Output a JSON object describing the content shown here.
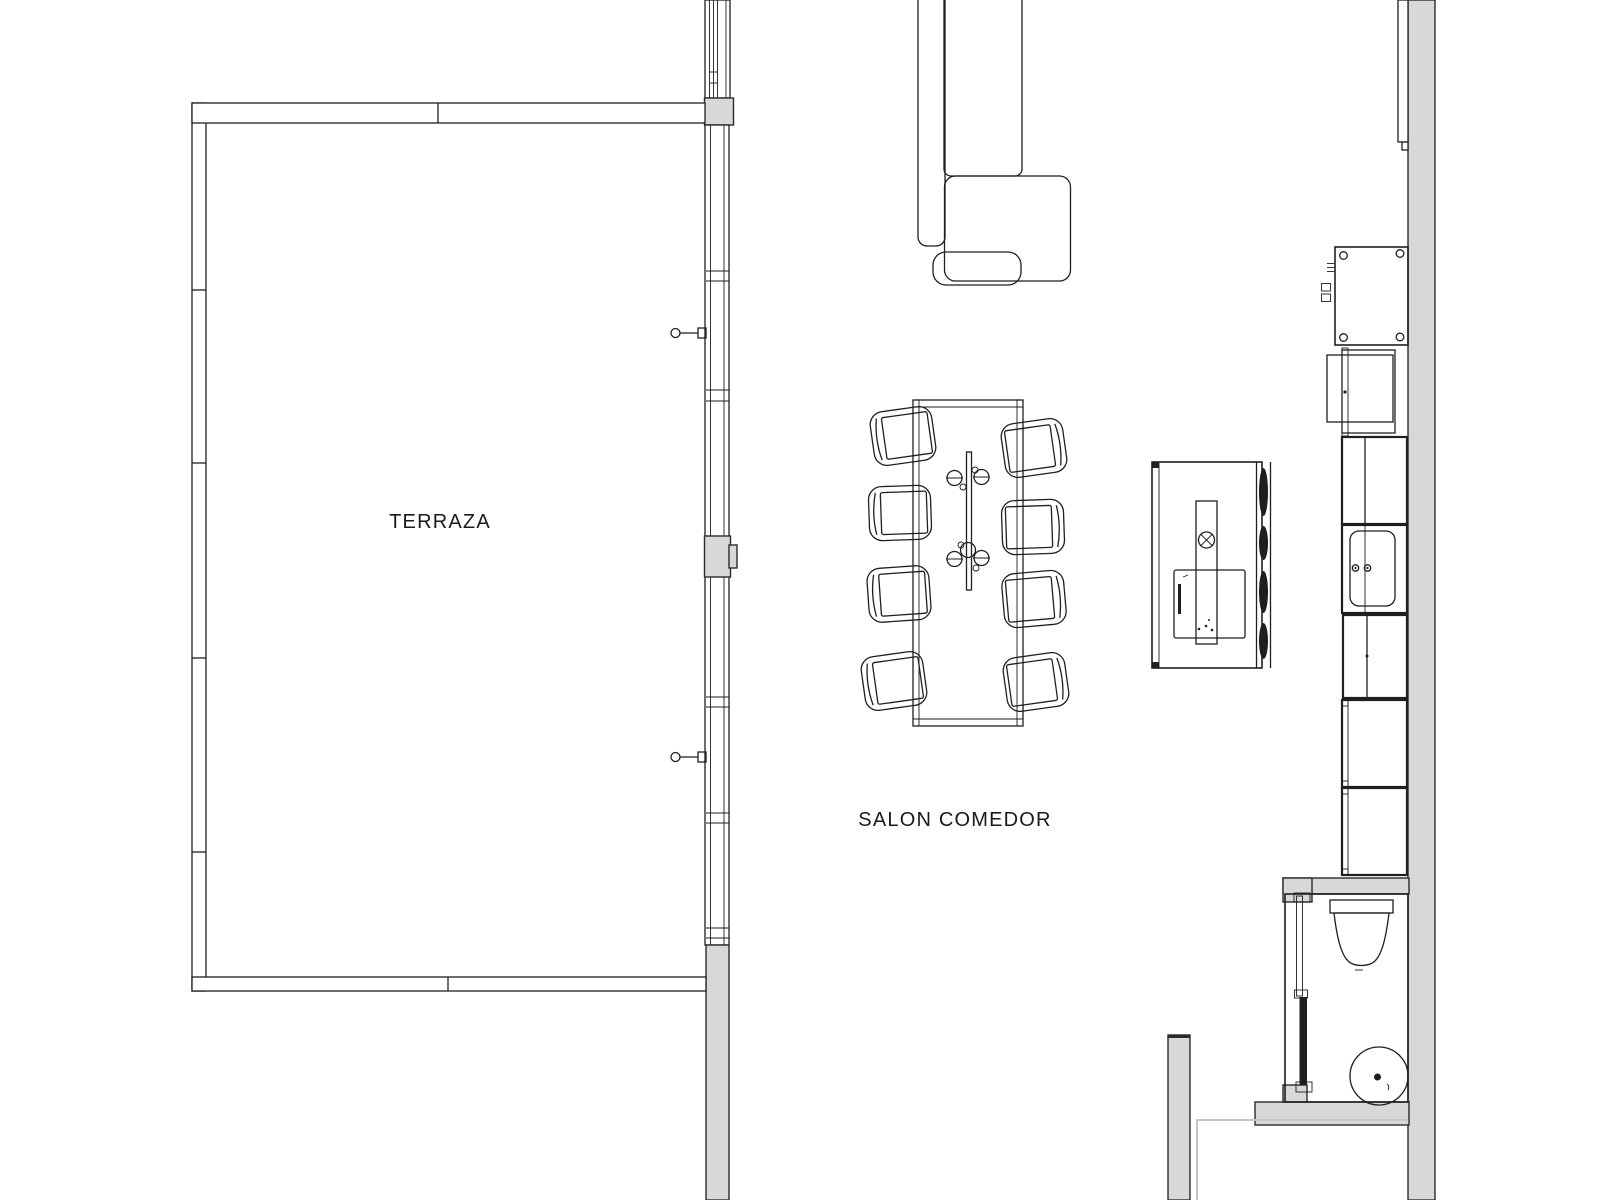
{
  "page": {
    "background": "#ffffff"
  },
  "rooms": {
    "terraza": {
      "label": "TERRAZA"
    },
    "salon_comedor": {
      "label": "SALON COMEDOR"
    }
  },
  "dining": {
    "chairs_count": 8
  },
  "colors": {
    "bg": "#ffffff",
    "line": "#1f1f1f",
    "wall": "#d8d8d8",
    "wallEdge": "#2b2b2b",
    "faint": "#c6c6c6",
    "text": "#1a1a1a"
  },
  "fixtures": [
    "terrace",
    "window-wall",
    "door-handles",
    "l-shaped-sofa",
    "sofa-cushion",
    "dining-table",
    "table-centerpiece",
    "dining-chair",
    "wood-stove",
    "stove-flue",
    "stove-louver",
    "tall-kitchen-unit",
    "kitchen-module",
    "kitchen-counter",
    "kitchen-sink",
    "bathroom",
    "sliding-door",
    "washbasin",
    "round-basin",
    "partition-wall"
  ]
}
